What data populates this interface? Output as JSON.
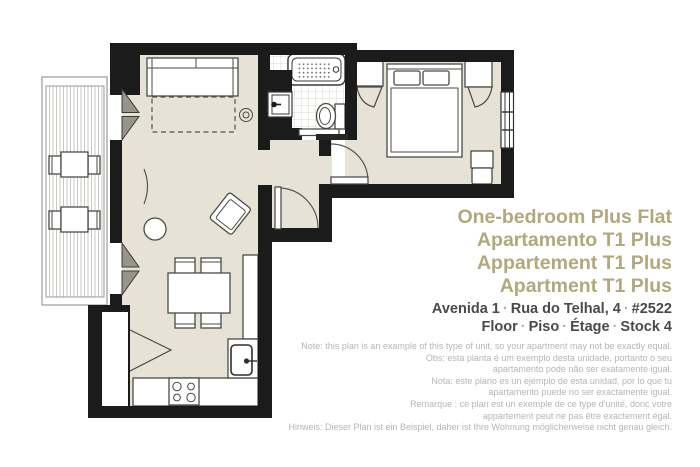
{
  "titles": [
    "One-bedroom Plus Flat",
    "Apartamento T1 Plus",
    "Appartement T1 Plus",
    "Apartment T1 Plus"
  ],
  "address": {
    "separator": "·",
    "line1": [
      "Avenida 1",
      "Rua do Telhal, 4",
      "#2522"
    ],
    "line2": [
      "Floor",
      "Piso",
      "Étage",
      "Stock 4"
    ]
  },
  "notes": [
    "Note: this plan is an example of this type of unit, so your apartment may not be exactly equal.",
    "Obs: esta planta é um exemplo desta unidade, portanto o seu",
    "apartamento pode não ser exatamente igual.",
    "Nota: este plano es un ejemplo de esta unidad, por lo que tu",
    "apartamento puede no ser exactamente igual.",
    "Remarque : ce plan est un exemple de ce type d'unité, donc votre",
    "appartement peut ne pas être exactement égal.",
    "Hinweis: Dieser Plan ist ein Beispiel, daher ist Ihre Wohnung möglicherweise nicht genau gleich."
  ],
  "colors": {
    "wall": "#1b1b1b",
    "floor": "#e6e3d6",
    "line": "#4a4a45",
    "door_fill": "#97958a",
    "title": "#b3a77c",
    "address": "#4a4a4a",
    "sep": "#b5ad8e",
    "note": "#b5b5b5",
    "balcony_outline": "#9a9a95",
    "bath_grid": "#d9d7cc",
    "deck_stripe": "#c9c9c4"
  }
}
